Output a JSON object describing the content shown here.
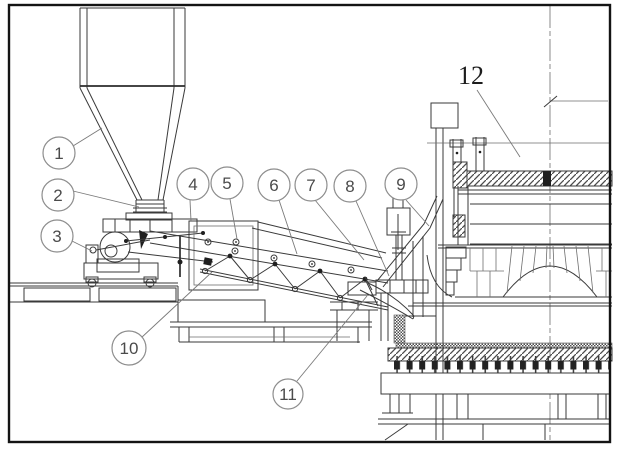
{
  "figure": {
    "background": "#ffffff",
    "ink": "#3a3a3a",
    "frame_color": "#141414",
    "callout_circle_stroke": "#8d8d8d",
    "callouts": [
      {
        "label": "1"
      },
      {
        "label": "2"
      },
      {
        "label": "3"
      },
      {
        "label": "4"
      },
      {
        "label": "5"
      },
      {
        "label": "6"
      },
      {
        "label": "7"
      },
      {
        "label": "8"
      },
      {
        "label": "9"
      },
      {
        "label": "10"
      },
      {
        "label": "11"
      },
      {
        "label": "12"
      }
    ]
  }
}
